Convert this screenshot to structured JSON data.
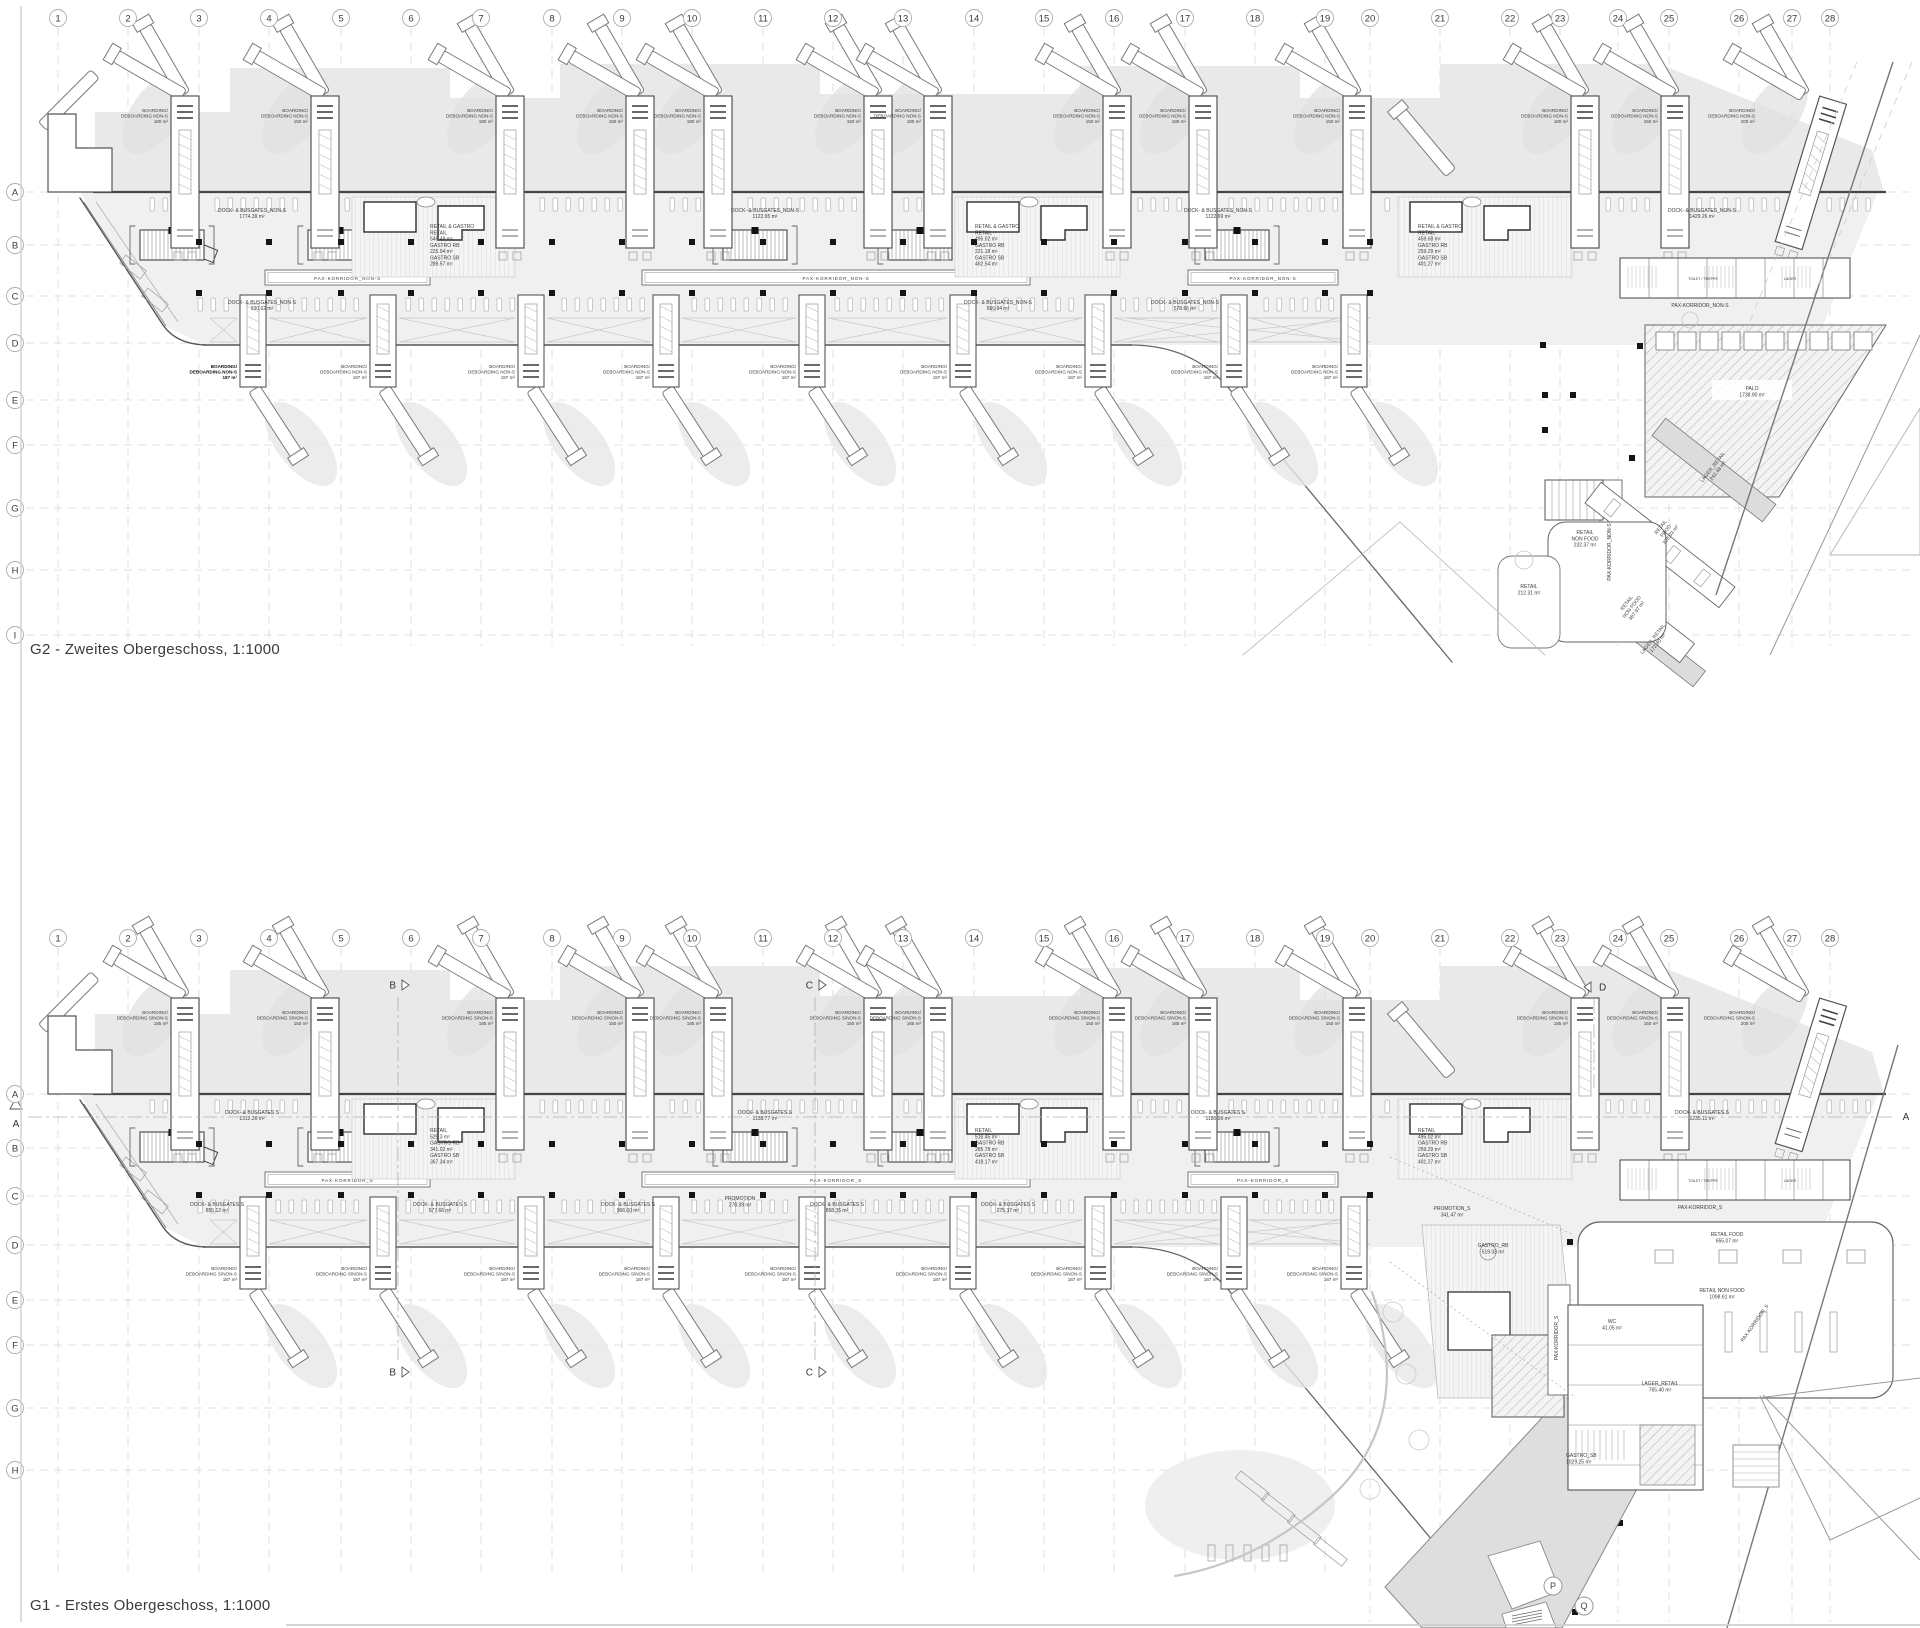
{
  "sheet": {
    "titles": {
      "g2": "G2 - Zweites Obergeschoss, 1:1000",
      "g1": "G1 - Erstes Obergeschoss, 1:1000"
    },
    "colors": {
      "paper": "#ffffff",
      "line": "#555555",
      "grid": "#d8d8d8",
      "apron": "#e9e9e9",
      "band": "#f0f0f0",
      "dark": "#1a1a1a",
      "mid": "#888888",
      "gray_fill": "#dedede"
    }
  },
  "grid": {
    "columns": [
      {
        "n": "1",
        "x": 58
      },
      {
        "n": "2",
        "x": 128
      },
      {
        "n": "3",
        "x": 199
      },
      {
        "n": "4",
        "x": 269
      },
      {
        "n": "5",
        "x": 341
      },
      {
        "n": "6",
        "x": 411
      },
      {
        "n": "7",
        "x": 481
      },
      {
        "n": "8",
        "x": 552
      },
      {
        "n": "9",
        "x": 622
      },
      {
        "n": "10",
        "x": 692
      },
      {
        "n": "11",
        "x": 763
      },
      {
        "n": "12",
        "x": 833
      },
      {
        "n": "13",
        "x": 903
      },
      {
        "n": "14",
        "x": 974
      },
      {
        "n": "15",
        "x": 1044
      },
      {
        "n": "16",
        "x": 1114
      },
      {
        "n": "17",
        "x": 1185
      },
      {
        "n": "18",
        "x": 1255
      },
      {
        "n": "19",
        "x": 1325
      },
      {
        "n": "20",
        "x": 1370
      },
      {
        "n": "21",
        "x": 1440
      },
      {
        "n": "22",
        "x": 1510
      },
      {
        "n": "23",
        "x": 1560
      },
      {
        "n": "24",
        "x": 1618
      },
      {
        "n": "25",
        "x": 1669
      },
      {
        "n": "26",
        "x": 1739
      },
      {
        "n": "27",
        "x": 1792
      },
      {
        "n": "28",
        "x": 1830
      }
    ],
    "g2_rows": [
      {
        "l": "A",
        "y": 192
      },
      {
        "l": "B",
        "y": 245
      },
      {
        "l": "C",
        "y": 296
      },
      {
        "l": "D",
        "y": 343
      },
      {
        "l": "E",
        "y": 400
      },
      {
        "l": "F",
        "y": 445
      },
      {
        "l": "G",
        "y": 508
      },
      {
        "l": "H",
        "y": 570
      },
      {
        "l": "I",
        "y": 635
      }
    ],
    "g1_rows": [
      {
        "l": "A",
        "y": 1094
      },
      {
        "l": "B",
        "y": 1148
      },
      {
        "l": "C",
        "y": 1196
      },
      {
        "l": "D",
        "y": 1245
      },
      {
        "l": "E",
        "y": 1300
      },
      {
        "l": "F",
        "y": 1345
      },
      {
        "l": "G",
        "y": 1408
      },
      {
        "l": "H",
        "y": 1470
      }
    ]
  },
  "plans": [
    {
      "id": "g2",
      "yA": 192,
      "circles_y": 18,
      "gate_label_top": [
        "BOARDING/",
        "DEBOARDING NON-S"
      ],
      "gate_label_bottom": [
        "BOARDING/",
        "DEBOARDING NON-S"
      ],
      "corridor_label": "PAX-KORRIDOR_NON-S",
      "top_gates": [
        {
          "x": 185,
          "area": "180 m²"
        },
        {
          "x": 325,
          "area": "150 m²"
        },
        {
          "x": 510,
          "area": "180 m²"
        },
        {
          "x": 640,
          "area": "150 m²"
        },
        {
          "x": 718,
          "area": "180 m²"
        },
        {
          "x": 878,
          "area": "150 m²"
        },
        {
          "x": 938,
          "area": "180 m²"
        },
        {
          "x": 1117,
          "area": "150 m²"
        },
        {
          "x": 1203,
          "area": "180 m²"
        },
        {
          "x": 1357,
          "area": "150 m²"
        },
        {
          "x": 1585,
          "area": "180 m²"
        },
        {
          "x": 1675,
          "area": "150 m²"
        },
        {
          "x": 1805,
          "area": "200 m²",
          "tilt": 17
        }
      ],
      "bottom_gates": [
        {
          "x": 253,
          "area": "187 m²",
          "bold": true
        },
        {
          "x": 383,
          "area": "187 m²"
        },
        {
          "x": 531,
          "area": "187 m²"
        },
        {
          "x": 666,
          "area": "187 m²"
        },
        {
          "x": 812,
          "area": "187 m²"
        },
        {
          "x": 963,
          "area": "187 m²"
        },
        {
          "x": 1098,
          "area": "187 m²"
        },
        {
          "x": 1234,
          "area": "187 m²"
        },
        {
          "x": 1354,
          "area": "187 m²"
        }
      ],
      "dock_labels_top": [
        {
          "x": 252,
          "name": "DOCK- & BUSGATES_NON-S",
          "area": "1774.39 m²"
        },
        {
          "x": 765,
          "name": "DOCK- & BUSGATES_NON-S",
          "area": "1122.95 m²"
        },
        {
          "x": 1218,
          "name": "DOCK- & BUSGATES_NON-S",
          "area": "1122.69 m²"
        },
        {
          "x": 1702,
          "name": "DOCK- & BUSGATES_NON-S",
          "area": "1429.26 m²"
        }
      ],
      "dock_labels_bottom": [
        {
          "x": 262,
          "name": "DOCK- & BUSGATES_NON-S",
          "area": "930.62 m²"
        },
        {
          "x": 998,
          "name": "DOCK- & BUSGATES_NON-S",
          "area": "566.94 m²"
        },
        {
          "x": 1185,
          "name": "DOCK- & BUSGATES_NON-S",
          "area": "578.66 m²"
        }
      ],
      "labels": [
        {
          "x": 430,
          "y": 228,
          "an": "start",
          "l": [
            "RETAIL & GASTRO",
            "RETAIL",
            "546.48 m²",
            "GASTRO RB",
            "225.04 m²",
            "GASTRO SB",
            "289.57 m²"
          ]
        },
        {
          "x": 975,
          "y": 228,
          "an": "start",
          "l": [
            "RETAIL & GASTRO",
            "RETAIL",
            "495.02 m²",
            "GASTRO RB",
            "221.18 m²",
            "GASTRO SB",
            "462.54 m²"
          ]
        },
        {
          "x": 1418,
          "y": 228,
          "an": "start",
          "l": [
            "RETAIL & GASTRO",
            "RETAIL",
            "459.68 m²",
            "GASTRO RB",
            "259.29 m²",
            "GASTRO SB",
            "401.27 m²"
          ]
        },
        {
          "x": 1700,
          "y": 307,
          "l": [
            "PAX-KORRIDOR_NON-S"
          ]
        },
        {
          "x": 1752,
          "y": 390,
          "l": [
            "PALO",
            "1738.90 m²"
          ]
        },
        {
          "x": 1585,
          "y": 534,
          "l": [
            "RETAIL",
            "NON FOOD",
            "232.37 m²"
          ]
        },
        {
          "x": 1529,
          "y": 588,
          "l": [
            "RETAIL",
            "212.31 m²"
          ]
        },
        {
          "x": 1662,
          "y": 528,
          "rot": -52,
          "l": [
            "RETAIL",
            "FOOD",
            "328.03 m²"
          ]
        },
        {
          "x": 1628,
          "y": 604,
          "rot": -52,
          "l": [
            "RETAIL",
            "NON FOOD",
            "367.97 m²"
          ]
        },
        {
          "x": 1714,
          "y": 468,
          "rot": -52,
          "l": [
            "LAGER_RETAIL",
            "242.48 m²"
          ]
        },
        {
          "x": 1654,
          "y": 640,
          "rot": -52,
          "l": [
            "LAGER_RETAIL",
            "172.80 m²"
          ]
        },
        {
          "x": 1611,
          "y": 552,
          "rot": -90,
          "l": [
            "PAX-KORRIDOR_NON-S"
          ]
        },
        {
          "x": 1703,
          "y": 280,
          "fs": 3.6,
          "l": [
            "TOILET / TREPPE"
          ]
        },
        {
          "x": 1790,
          "y": 280,
          "fs": 3.6,
          "l": [
            "LAGER"
          ]
        }
      ]
    },
    {
      "id": "g1",
      "yA": 1094,
      "circles_y": 938,
      "gate_label_top": [
        "BOARDING/",
        "DEBOARDING S/NON-S"
      ],
      "gate_label_bottom": [
        "BOARDING/",
        "DEBOARDING S/NON-S"
      ],
      "corridor_label": "PAX-KORRIDOR_S",
      "top_gates": [
        {
          "x": 185,
          "area": "185 m²"
        },
        {
          "x": 325,
          "area": "150 m²"
        },
        {
          "x": 510,
          "area": "185 m²"
        },
        {
          "x": 640,
          "area": "150 m²"
        },
        {
          "x": 718,
          "area": "185 m²"
        },
        {
          "x": 878,
          "area": "150 m²"
        },
        {
          "x": 938,
          "area": "185 m²"
        },
        {
          "x": 1117,
          "area": "150 m²"
        },
        {
          "x": 1203,
          "area": "185 m²"
        },
        {
          "x": 1357,
          "area": "150 m²"
        },
        {
          "x": 1585,
          "area": "185 m²"
        },
        {
          "x": 1675,
          "area": "150 m²"
        },
        {
          "x": 1805,
          "area": "200 m²",
          "tilt": 17
        }
      ],
      "bottom_gates": [
        {
          "x": 253,
          "area": "187 m²"
        },
        {
          "x": 383,
          "area": "187 m²"
        },
        {
          "x": 531,
          "area": "187 m²"
        },
        {
          "x": 666,
          "area": "187 m²"
        },
        {
          "x": 812,
          "area": "187 m²"
        },
        {
          "x": 963,
          "area": "187 m²"
        },
        {
          "x": 1098,
          "area": "187 m²"
        },
        {
          "x": 1234,
          "area": "187 m²"
        },
        {
          "x": 1354,
          "area": "187 m²"
        }
      ],
      "dock_labels_top": [
        {
          "x": 252,
          "name": "DOCK- & BUSGATES S",
          "area": "1312.26 m²"
        },
        {
          "x": 765,
          "name": "DOCK- & BUSGATES S",
          "area": "1138.77 m²"
        },
        {
          "x": 1218,
          "name": "DOCK- & BUSGATES S",
          "area": "1180.06 m²"
        },
        {
          "x": 1702,
          "name": "DOCK- & BUSGATES S",
          "area": "1235.11 m²"
        }
      ],
      "dock_labels_bottom": [
        {
          "x": 217,
          "name": "DOCK- & BUSGATES S",
          "area": "855.12 m²"
        },
        {
          "x": 440,
          "name": "DOCK- & BUSGATES S",
          "area": "577.66 m²"
        },
        {
          "x": 628,
          "name": "DOCK- & BUSGATES S",
          "area": "966.60 m²"
        },
        {
          "x": 837,
          "name": "DOCK- & BUSGATES S",
          "area": "858.35 m²"
        },
        {
          "x": 1008,
          "name": "DOCK- & BUSGATES S",
          "area": "275.37 m²"
        }
      ],
      "labels": [
        {
          "x": 430,
          "y": 1132,
          "an": "start",
          "l": [
            "RETAIL",
            "525.3 m²",
            "GASTRO RB",
            "341.02 m²",
            "GASTRO SB",
            "367.34 m²"
          ]
        },
        {
          "x": 975,
          "y": 1132,
          "an": "start",
          "l": [
            "RETAIL",
            "516.45 m²",
            "GASTRO RB",
            "285.78 m²",
            "GASTRO SB",
            "418.17 m²"
          ]
        },
        {
          "x": 1418,
          "y": 1132,
          "an": "start",
          "l": [
            "RETAIL",
            "495.02 m²",
            "GASTRO RB",
            "259.29 m²",
            "GASTRO SB",
            "401.27 m²"
          ]
        },
        {
          "x": 740,
          "y": 1200,
          "l": [
            "PROMOTION",
            "278.39 m²"
          ]
        },
        {
          "x": 1452,
          "y": 1210,
          "l": [
            "PROMOTION_S",
            "341.47 m²"
          ]
        },
        {
          "x": 1700,
          "y": 1209,
          "l": [
            "PAX-KORRIDOR_S"
          ]
        },
        {
          "x": 1727,
          "y": 1236,
          "l": [
            "RETAIL FOOD",
            "655.07 m²"
          ]
        },
        {
          "x": 1722,
          "y": 1292,
          "l": [
            "RETAIL NON FOOD",
            "1098.61 m²"
          ]
        },
        {
          "x": 1493,
          "y": 1247,
          "l": [
            "GASTRO_RB",
            "519.03 m²"
          ]
        },
        {
          "x": 1612,
          "y": 1323,
          "l": [
            "WC",
            "41.05 m²"
          ]
        },
        {
          "x": 1660,
          "y": 1385,
          "l": [
            "LAGER_RETAIL",
            "765.40 m²"
          ]
        },
        {
          "x": 1566,
          "y": 1457,
          "an": "start",
          "l": [
            "GASTRO_SB",
            "1029.25 m²"
          ]
        },
        {
          "x": 1558,
          "y": 1338,
          "rot": -90,
          "l": [
            "PAX-KORRIDOR_S"
          ]
        },
        {
          "x": 1756,
          "y": 1324,
          "rot": -55,
          "l": [
            "PAX-KORRIDOR_S"
          ]
        },
        {
          "x": 1703,
          "y": 1182,
          "fs": 3.6,
          "l": [
            "TOILET / TREPPE"
          ]
        },
        {
          "x": 1790,
          "y": 1182,
          "fs": 3.6,
          "l": [
            "LAGER"
          ]
        }
      ],
      "section_markers": [
        {
          "letter": "B",
          "x": 398,
          "y1": 985,
          "y2": 1372
        },
        {
          "letter": "C",
          "x": 815,
          "y1": 985,
          "y2": 1372
        },
        {
          "letter": "D",
          "x": 1597,
          "y1": 987,
          "dir": "left"
        },
        {
          "letter": "A",
          "type": "h",
          "y": 1117,
          "xl": 16,
          "xr": 1906
        },
        {
          "letter": "P",
          "type": "circle",
          "x": 1553,
          "y": 1586
        },
        {
          "letter": "Q",
          "type": "circle",
          "x": 1584,
          "y": 1606
        }
      ]
    }
  ]
}
